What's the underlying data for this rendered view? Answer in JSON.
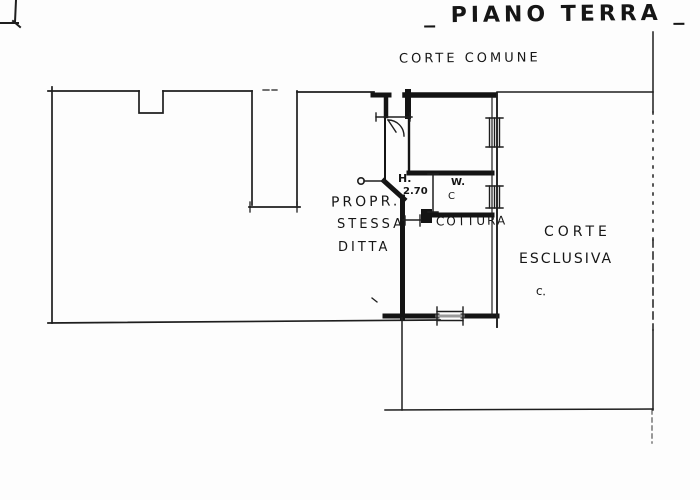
{
  "title": "_ PIANO TERRA _",
  "labels": {
    "corte_comune": "CORTE COMUNE",
    "owner_line1": "PROPR.",
    "owner_line2": "STESSA",
    "owner_line3": "DITTA",
    "height_label": "H.",
    "height_value": "2.70",
    "wc_line1": "W.",
    "wc_line2": "C",
    "kitchen": "COTTURA",
    "corte_esclusiva_line1": "CORTE",
    "corte_esclusiva_line2": "ESCLUSIVA",
    "corte_esclusiva_mark": "c."
  },
  "colors": {
    "ink": "#1b1b1b",
    "paper": "#fdfdfd"
  }
}
